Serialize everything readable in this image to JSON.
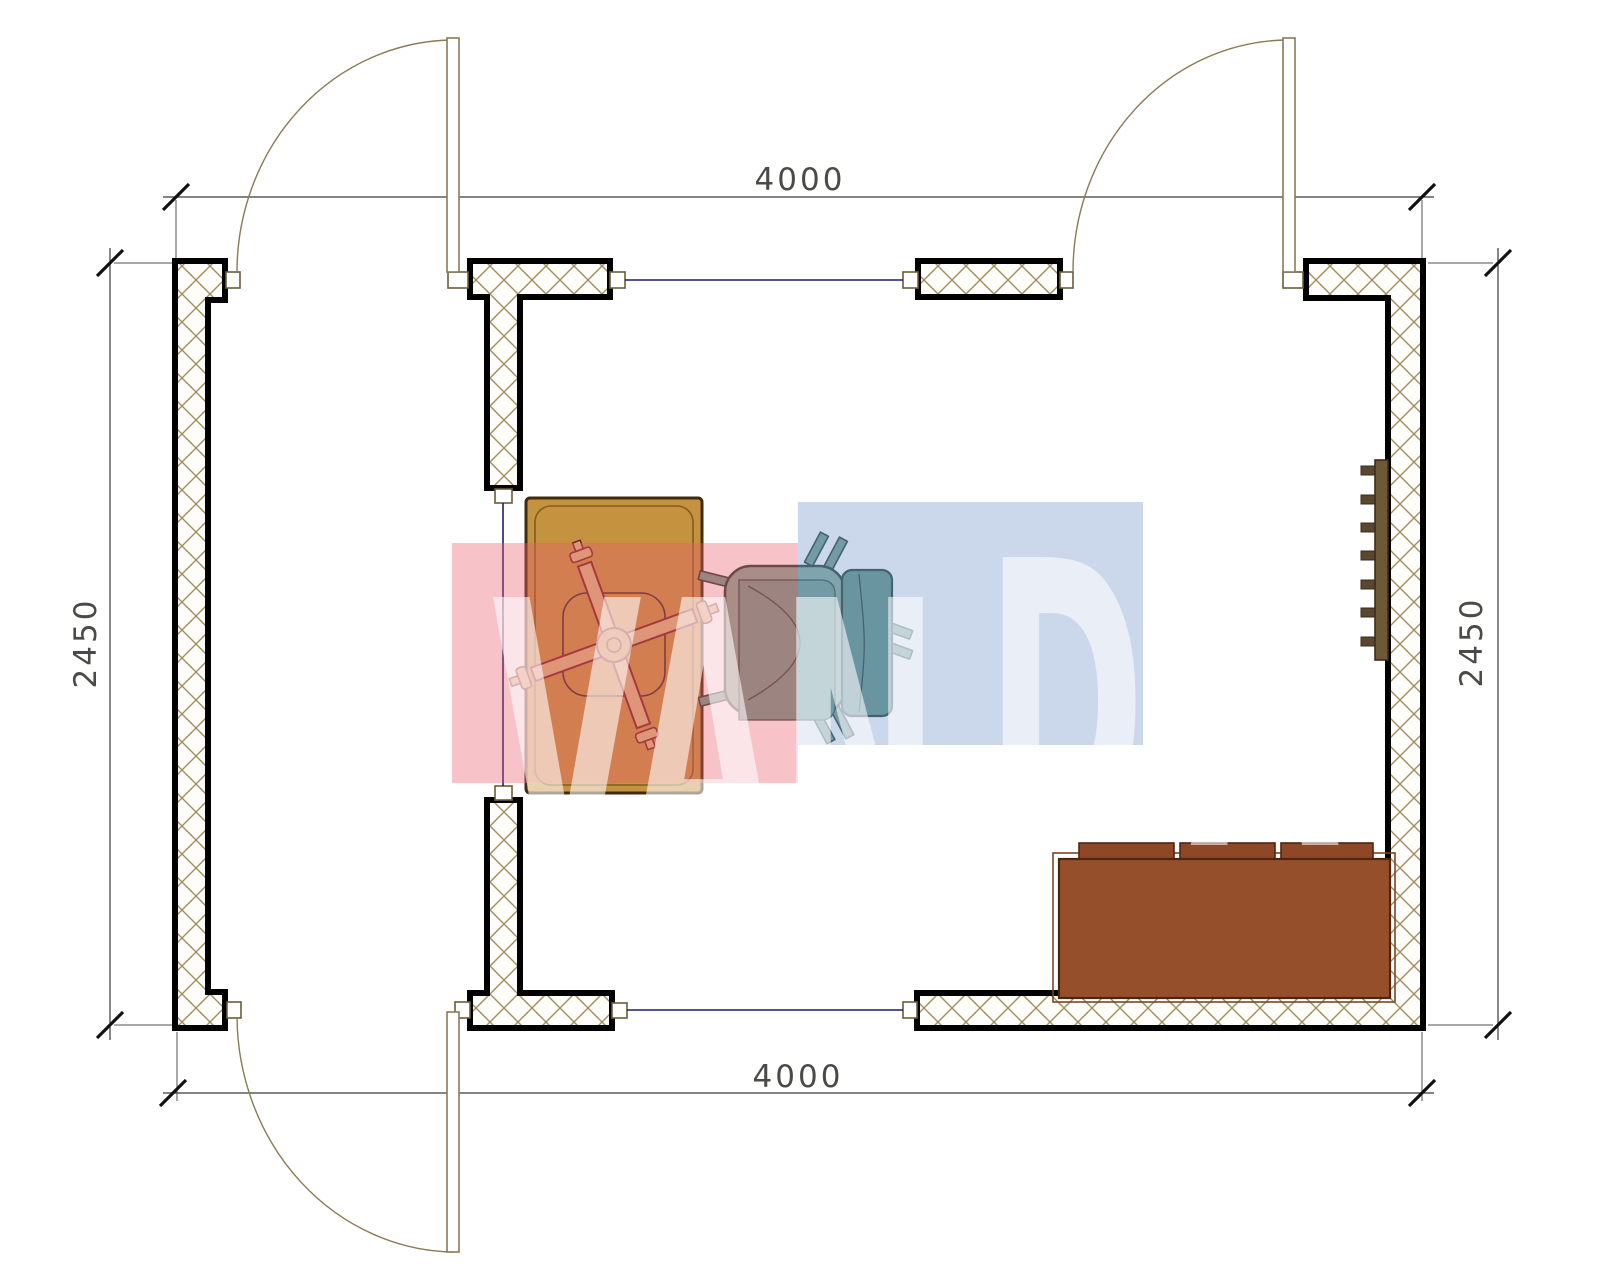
{
  "page": {
    "type": "architectural-floor-plan",
    "background": "#ffffff"
  },
  "dimensions": {
    "top": {
      "label": "4000"
    },
    "bottom": {
      "label": "4000"
    },
    "left": {
      "label": "2450"
    },
    "right": {
      "label": "2450"
    }
  },
  "watermark": {
    "text": "VANDA",
    "segment_left": "VAN",
    "segment_right": "DA",
    "pink_color": "#e95f6e",
    "blue_color": "#7d9bcd",
    "letter_color": "#ffffff"
  },
  "room": {
    "doors_count": "3",
    "furniture": [
      {
        "name": "desk"
      },
      {
        "name": "office-chair"
      },
      {
        "name": "armchair"
      },
      {
        "name": "sofa"
      },
      {
        "name": "wall-shelf"
      }
    ]
  },
  "colors": {
    "wall_hatch": "#a08e5e",
    "wall_outline": "#000000",
    "frame": "#6b5b3a",
    "door": "#8a7a55",
    "window_line": "#1c1c6e",
    "dim_line": "#3a3a38",
    "desk": "#c5923f",
    "desk_border": "#3f2c10",
    "chair_star_fill": "#d9b77c",
    "chair_star_line": "#7c2222",
    "armchair_seat": "#82aa97",
    "armchair_panel": "#6c9c8c",
    "armchair_back": "#5d9184",
    "armchair_line": "#223c34",
    "sofa": "#964f2b",
    "sofa_cushion": "#8f4827",
    "sofa_border": "#50250f",
    "shelf_bar": "#6f5838",
    "shelf_tooth": "#5a4730"
  }
}
